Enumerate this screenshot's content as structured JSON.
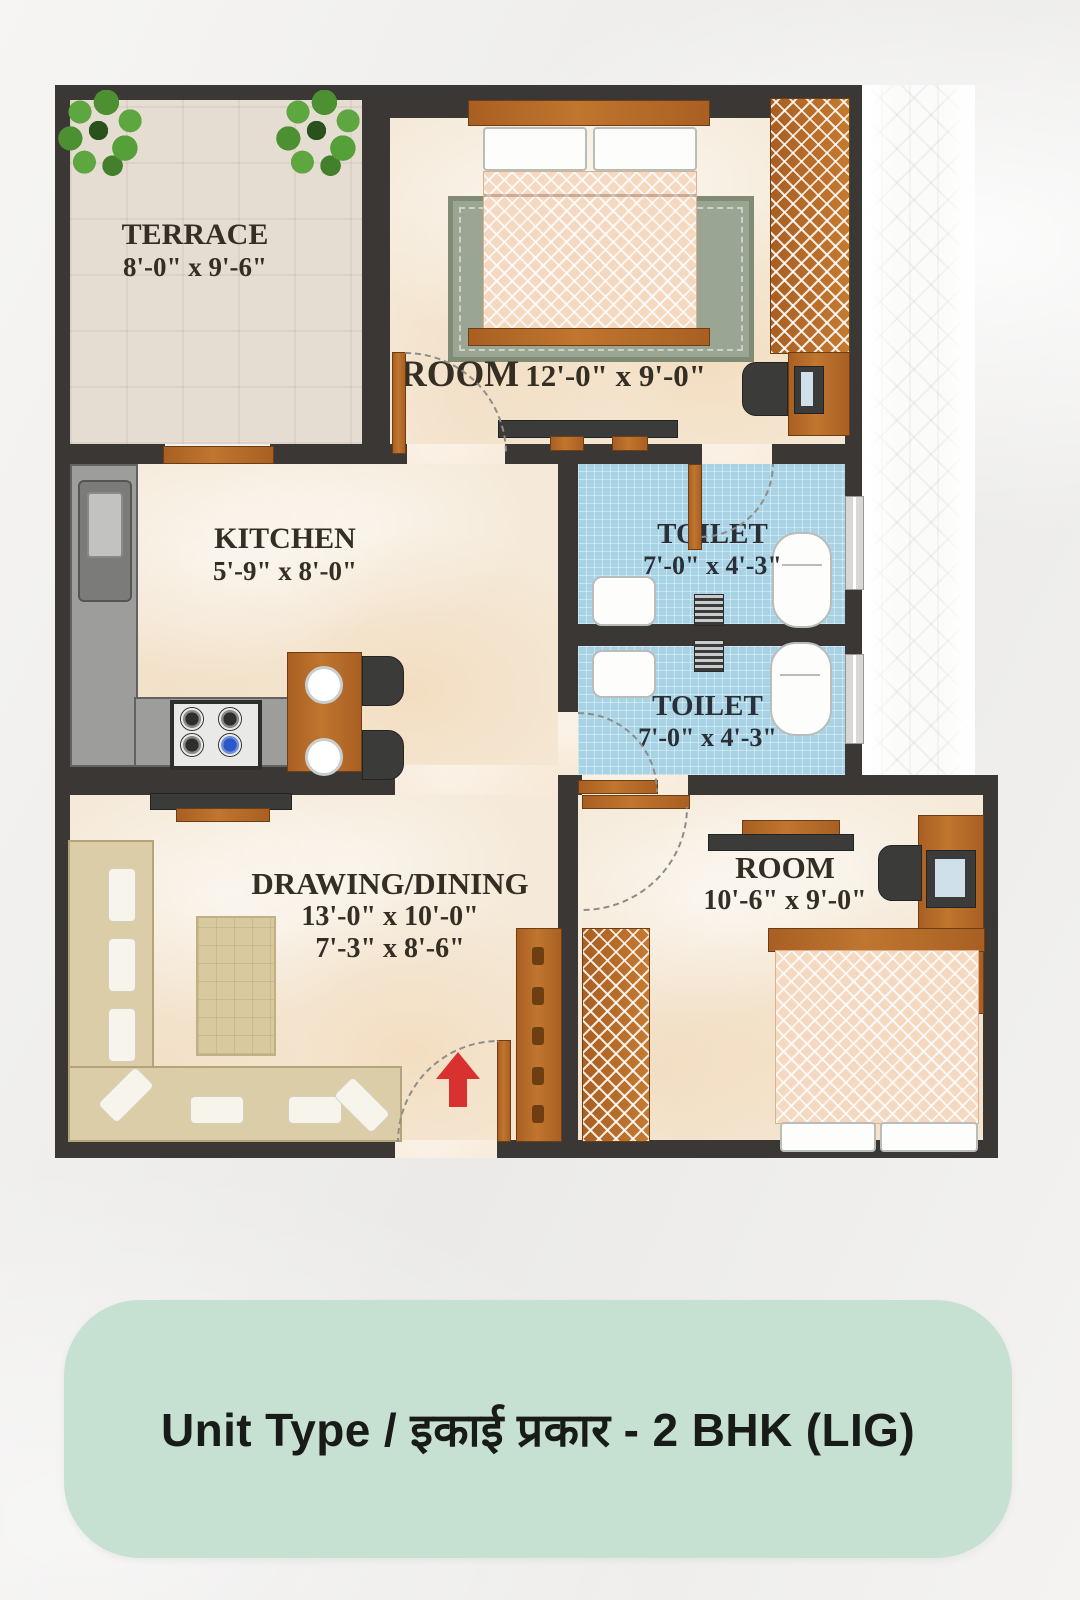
{
  "page_background": "#f1f0ee",
  "caption": {
    "text": "Unit Type / इकाई प्रकार - 2 BHK (LIG)",
    "panel_color": "#c6e1d2",
    "text_color": "#181b18"
  },
  "plan": {
    "wall_color": "#3a3734",
    "floor_colors": {
      "marble": "#f5ead9",
      "terrace": "#e5dcd2",
      "toilet": "#a8d3e5"
    },
    "accent_colors": {
      "wood": "#b06a2c",
      "counter_gray": "#9d9d9b",
      "sofa": "#dbcda8",
      "bed_blanket": "#f4d8c0",
      "entry_arrow": "#d93030",
      "plant_green": "#56a03a"
    },
    "rooms": {
      "terrace": {
        "label": "TERRACE",
        "dims": "8'-0\" x 9'-6\""
      },
      "room1": {
        "label": "ROOM",
        "dims": "12'-0\" x 9'-0\""
      },
      "kitchen": {
        "label": "KITCHEN",
        "dims": "5'-9\" x 8'-0\""
      },
      "toilet1": {
        "label": "TOILET",
        "dims": "7'-0\" x 4'-3\""
      },
      "toilet2": {
        "label": "TOILET",
        "dims": "7'-0\" x 4'-3\""
      },
      "drawing_dining": {
        "label": "DRAWING/DINING",
        "dims": "13'-0\" x 10'-0\"",
        "dims2": "7'-3\" x 8'-6\""
      },
      "room2": {
        "label": "ROOM",
        "dims": "10'-6\" x 9'-0\""
      }
    }
  }
}
